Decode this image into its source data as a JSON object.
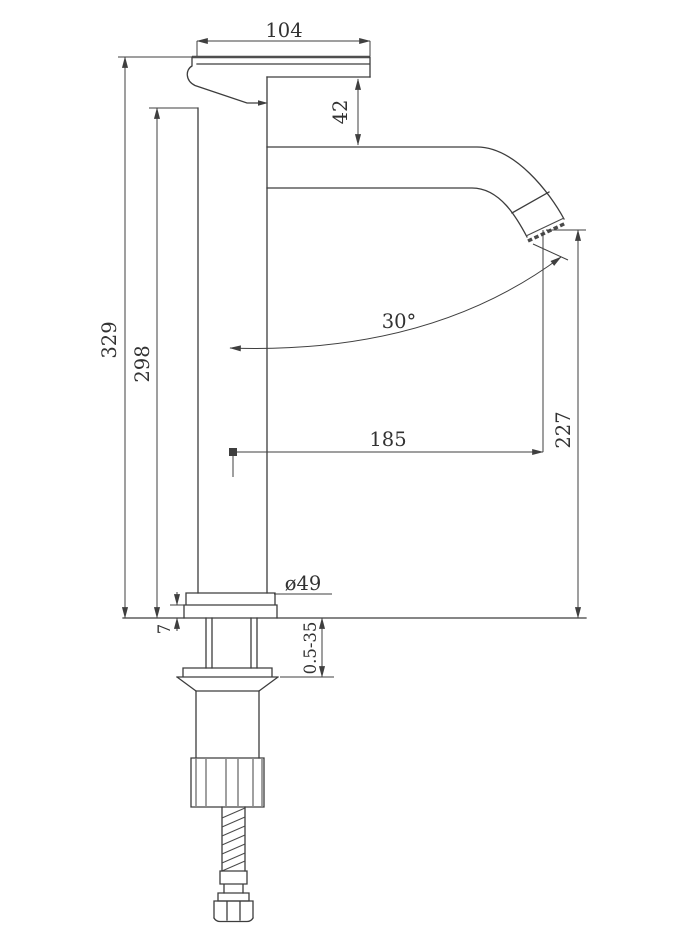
{
  "drawing": {
    "title": "Tall basin mixer tap - dimensioned side elevation",
    "dims": {
      "handle_length": "104",
      "upper_body_height": "42",
      "total_height": "329",
      "column_height": "298",
      "spout_angle": "30°",
      "spout_reach": "185",
      "outlet_height": "227",
      "base_diameter": "ø49",
      "base_flange_height": "7",
      "mounting_thickness_range": "0.5-35"
    }
  }
}
